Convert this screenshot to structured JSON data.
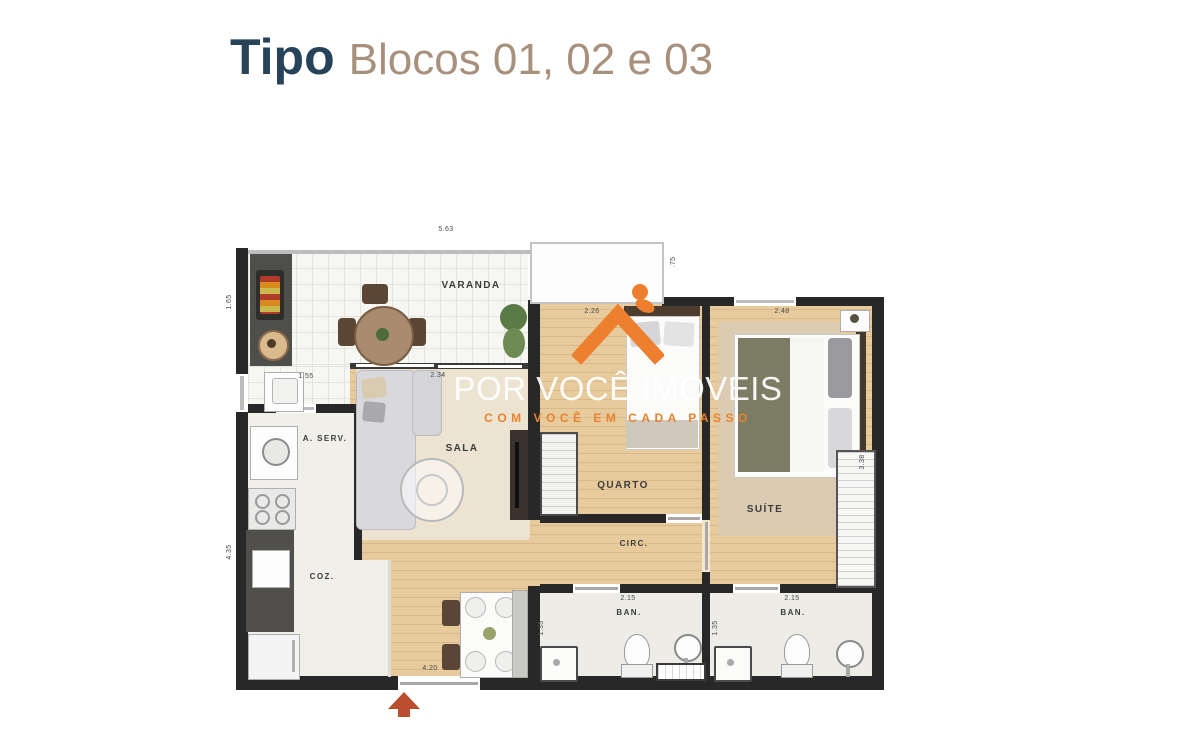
{
  "header": {
    "title": "Tipo",
    "subtitle": "Blocos 01, 02 e 03"
  },
  "colors": {
    "title_blue": "#27435a",
    "subtitle_tan": "#a8917c",
    "wall_dark": "#282828",
    "wood_floor": "#e7cb9c",
    "watermark_orange": "#ee7f2f",
    "entry_arrow": "#b94f2e"
  },
  "floorplan": {
    "rooms": {
      "varanda": "VARANDA",
      "sala": "SALA",
      "quarto": "QUARTO",
      "suite": "SUÍTE",
      "circ": "CIRC.",
      "ban1": "BAN.",
      "ban2": "BAN.",
      "aserv": "A. SERV.",
      "coz": "COZ."
    },
    "dimensions": {
      "top": "5.63",
      "varanda_side": ".75",
      "left_upper": "1.65",
      "left_lower": "4.35",
      "aserv_width": "1.55",
      "sala_width": "2.34",
      "quarto_width": "2.26",
      "suite_width": "2.48",
      "suite_depth": "3.38",
      "ban1_width": "2.15",
      "ban1_depth": "1.35",
      "ban2_width": "2.15",
      "ban2_depth": "1.35",
      "entry_width": "4.20"
    }
  },
  "watermark": {
    "brand": "POR VOCÊ IMÓVEIS",
    "tagline": "COM VOCÊ EM CADA PASSO"
  }
}
